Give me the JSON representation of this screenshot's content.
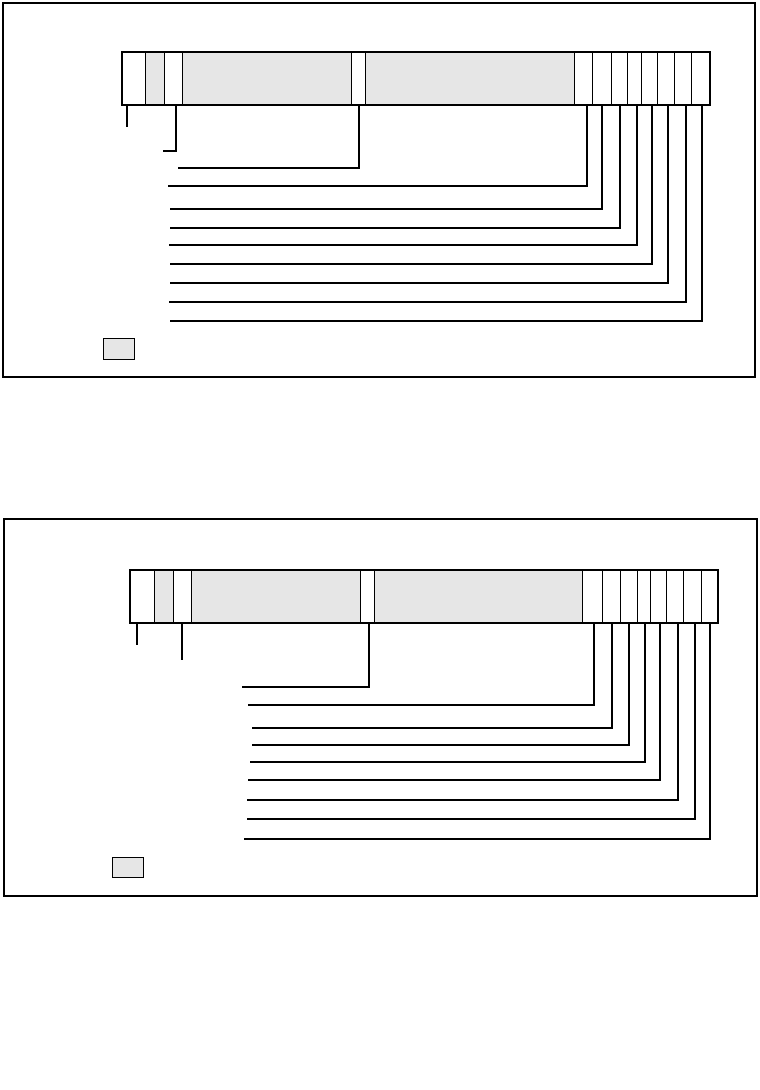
{
  "page": {
    "width": 760,
    "height": 1090,
    "background": "#ffffff",
    "line_color": "#000000",
    "cell_gray": "#e6e6e6",
    "cell_white": "#ffffff",
    "visible_text": ""
  },
  "diagrams": [
    {
      "id": "format-diagram-1",
      "box": {
        "x": 2,
        "y": 2,
        "w": 754,
        "h": 376
      },
      "bar": {
        "x": 121,
        "y": 51,
        "w": 590,
        "h": 55,
        "segments": [
          {
            "w": 22,
            "shade": "white"
          },
          {
            "w": 19,
            "shade": "gray"
          },
          {
            "w": 18,
            "shade": "white"
          },
          {
            "w": 171,
            "shade": "gray"
          },
          {
            "w": 14,
            "shade": "white"
          },
          {
            "w": 210,
            "shade": "gray"
          },
          {
            "w": 18,
            "shade": "white"
          },
          {
            "w": 19,
            "shade": "white"
          },
          {
            "w": 16,
            "shade": "white"
          },
          {
            "w": 15,
            "shade": "white"
          },
          {
            "w": 16,
            "shade": "white"
          },
          {
            "w": 17,
            "shade": "white"
          },
          {
            "w": 17,
            "shade": "white"
          },
          {
            "w": 18,
            "shade": "white"
          }
        ]
      },
      "callouts": [
        {
          "x": 126,
          "y": 125
        },
        {
          "x": 175,
          "y": 150,
          "run_to_x": 163
        },
        {
          "x": 358,
          "y": 167,
          "run_to_x": 178
        },
        {
          "x": 586,
          "y": 185,
          "run_to_x": 168
        },
        {
          "x": 601,
          "y": 208,
          "run_to_x": 170
        },
        {
          "x": 619,
          "y": 227,
          "run_to_x": 170
        },
        {
          "x": 636,
          "y": 244,
          "run_to_x": 169
        },
        {
          "x": 651,
          "y": 263,
          "run_to_x": 170
        },
        {
          "x": 667,
          "y": 282,
          "run_to_x": 170
        },
        {
          "x": 685,
          "y": 301,
          "run_to_x": 169
        },
        {
          "x": 701,
          "y": 320,
          "run_to_x": 170
        }
      ],
      "legend_box": {
        "x": 103,
        "y": 338,
        "w": 32,
        "h": 22
      }
    },
    {
      "id": "format-diagram-2",
      "box": {
        "x": 3,
        "y": 518,
        "w": 755,
        "h": 379
      },
      "bar": {
        "x": 129,
        "y": 569,
        "w": 590,
        "h": 55,
        "segments": [
          {
            "w": 23,
            "shade": "white"
          },
          {
            "w": 19,
            "shade": "gray"
          },
          {
            "w": 18,
            "shade": "white"
          },
          {
            "w": 171,
            "shade": "gray"
          },
          {
            "w": 14,
            "shade": "white"
          },
          {
            "w": 209,
            "shade": "gray"
          },
          {
            "w": 20,
            "shade": "white"
          },
          {
            "w": 18,
            "shade": "white"
          },
          {
            "w": 17,
            "shade": "white"
          },
          {
            "w": 14,
            "shade": "white"
          },
          {
            "w": 16,
            "shade": "white"
          },
          {
            "w": 17,
            "shade": "white"
          },
          {
            "w": 18,
            "shade": "white"
          },
          {
            "w": 16,
            "shade": "white"
          }
        ]
      },
      "callouts": [
        {
          "x": 136,
          "y": 643
        },
        {
          "x": 181,
          "y": 658
        },
        {
          "x": 368,
          "y": 686,
          "run_to_x": 242
        },
        {
          "x": 593,
          "y": 704,
          "run_to_x": 248
        },
        {
          "x": 611,
          "y": 727,
          "run_to_x": 252
        },
        {
          "x": 628,
          "y": 744,
          "run_to_x": 252
        },
        {
          "x": 644,
          "y": 761,
          "run_to_x": 250
        },
        {
          "x": 659,
          "y": 779,
          "run_to_x": 248
        },
        {
          "x": 677,
          "y": 799,
          "run_to_x": 247
        },
        {
          "x": 694,
          "y": 818,
          "run_to_x": 247
        },
        {
          "x": 709,
          "y": 838,
          "run_to_x": 244
        }
      ],
      "legend_box": {
        "x": 112,
        "y": 857,
        "w": 32,
        "h": 21
      }
    }
  ]
}
